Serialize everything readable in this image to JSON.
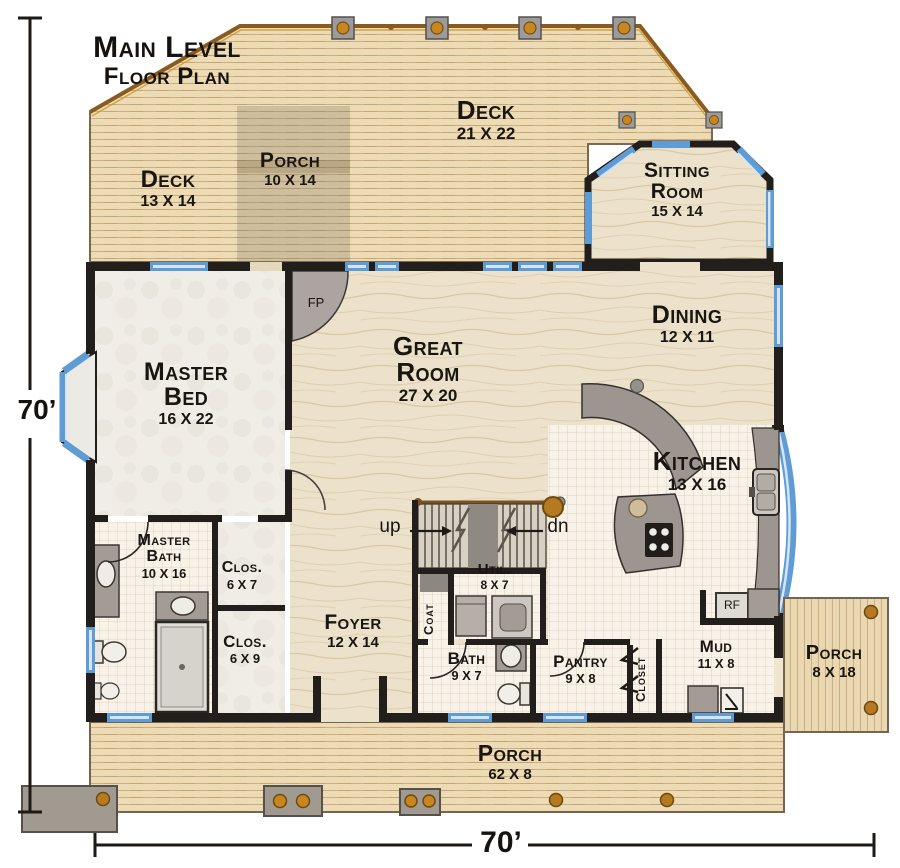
{
  "title": {
    "line1": "Main Level",
    "line2": "Floor Plan"
  },
  "dimensions": {
    "left": "70’",
    "bottom": "70’"
  },
  "rooms": {
    "deck_top": {
      "name": "Deck",
      "size": "21 X 22"
    },
    "deck_left": {
      "name": "Deck",
      "size": "13 X 14"
    },
    "porch_top": {
      "name": "Porch",
      "size": "10 X 14"
    },
    "sitting_room": {
      "name": "Sitting Room",
      "size": "15 X 14"
    },
    "dining": {
      "name": "Dining",
      "size": "12 X 11"
    },
    "great_room": {
      "name": "Great Room",
      "size": "27 X 20"
    },
    "master_bed": {
      "name": "Master Bed",
      "size": "16 X 22"
    },
    "kitchen": {
      "name": "Kitchen",
      "size": "13 X 16"
    },
    "master_bath": {
      "name": "Master Bath",
      "size": "10 X 16"
    },
    "closet_a": {
      "name": "Clos.",
      "size": "6 X 7"
    },
    "closet_b": {
      "name": "Clos.",
      "size": "6 X 9"
    },
    "foyer": {
      "name": "Foyer",
      "size": "12 X 14"
    },
    "utility": {
      "name": "Util.",
      "size": "8 X 7"
    },
    "bath": {
      "name": "Bath",
      "size": "9 X 7"
    },
    "pantry": {
      "name": "Pantry",
      "size": "9 X 8"
    },
    "mud": {
      "name": "Mud",
      "size": "11 X 8"
    },
    "porch_right": {
      "name": "Porch",
      "size": "8 X 18"
    },
    "porch_bottom": {
      "name": "Porch",
      "size": "62 X 8"
    },
    "coat": {
      "name": "Coat"
    },
    "closet_hall": {
      "name": "Closet"
    }
  },
  "annotations": {
    "stairs_up": "up",
    "stairs_down": "dn",
    "fireplace": "FP",
    "refrigerator": "RF"
  },
  "colors": {
    "wall": "#221e1b",
    "window_blue": "#5f9bd4",
    "window_light": "#d5e5f4",
    "deck_wood": "#ecdbb4",
    "interior_wood": "#ece2cb",
    "tile": "#f8f2e9",
    "carpet": "#f0ede7",
    "counter_gray": "#9c9590",
    "railing_brown": "#b5791f",
    "label_text": "#191511"
  }
}
